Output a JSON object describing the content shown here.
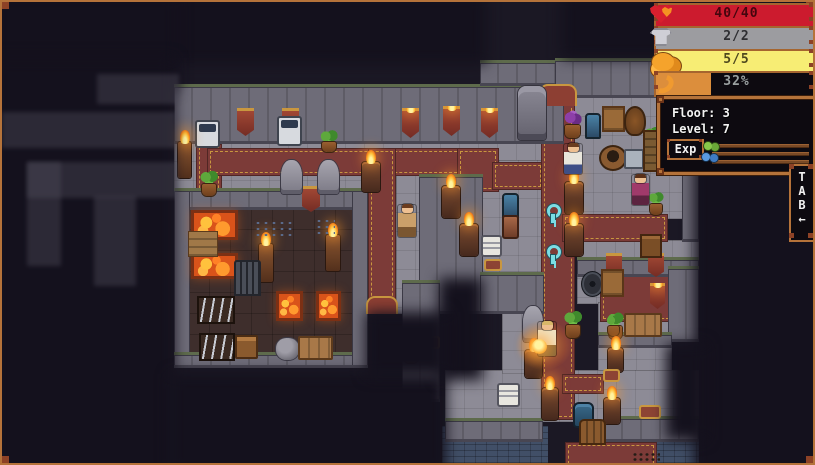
{
  "hud": {
    "bars": [
      {
        "name": "health-bar",
        "icon": "heart-icon",
        "label": "40/40",
        "fill_color": "#cc1b2e",
        "fill_pct": 100,
        "text_color": "#44060e",
        "y": 1
      },
      {
        "name": "armor-bar",
        "icon": "armor-icon",
        "label": "2/2",
        "fill_color": "#9c9ca0",
        "fill_pct": 100,
        "text_color": "#2e2e32",
        "y": 24
      },
      {
        "name": "charge-bar",
        "icon": "gold-icon",
        "label": "5/5",
        "fill_color": "#f7ed74",
        "fill_pct": 100,
        "text_color": "#4e481e",
        "y": 47
      },
      {
        "name": "hunger-bar",
        "icon": "horn-icon",
        "label": "32%",
        "fill_color": "#dc8e3c",
        "fill_pct": 34,
        "text_color": "#9aa0a0",
        "y": 69
      }
    ],
    "info": {
      "floor_label": "Floor: 3",
      "level_label": "Level: 7",
      "exp_button": "Exp"
    },
    "tab": {
      "l1": "T",
      "l2": "A",
      "l3": "B",
      "arrow": "←"
    }
  },
  "colors": {
    "frame": "#b5733a",
    "background": "#1b1824",
    "carpet": "#7c3b38",
    "gold_trim": "#c9973f",
    "lava": "#d9531a",
    "stone": "#8d8b96"
  },
  "map": {
    "tiles": [
      {
        "t": "stone",
        "r": [
          172,
          140,
          390,
          76
        ]
      },
      {
        "t": "stone",
        "r": [
          394,
          172,
          24,
          140
        ]
      },
      {
        "t": "stone",
        "r": [
          553,
          95,
          144,
          122
        ]
      },
      {
        "t": "stone",
        "r": [
          478,
          158,
          64,
          112
        ]
      },
      {
        "t": "stone",
        "r": [
          575,
          238,
          122,
          64
        ]
      },
      {
        "t": "stone",
        "r": [
          596,
          300,
          74,
          140
        ]
      },
      {
        "t": "stone",
        "r": [
          443,
          368,
          254,
          52
        ]
      },
      {
        "t": "stone",
        "r": [
          500,
          310,
          42,
          62
        ]
      },
      {
        "t": "forge",
        "r": [
          186,
          206,
          166,
          146
        ]
      },
      {
        "t": "water",
        "r": [
          440,
          424,
          106,
          40
        ]
      },
      {
        "t": "water",
        "r": [
          628,
          436,
          69,
          28
        ]
      },
      {
        "t": "carpet",
        "r": [
          194,
          142,
          26,
          52
        ]
      },
      {
        "t": "carpet",
        "r": [
          205,
          146,
          258,
          28
        ]
      },
      {
        "t": "carpet",
        "r": [
          455,
          146,
          42,
          44
        ]
      },
      {
        "t": "carpet",
        "r": [
          490,
          160,
          52,
          28
        ]
      },
      {
        "t": "carpet",
        "r": [
          366,
          146,
          28,
          166
        ]
      },
      {
        "t": "carpet",
        "r": [
          539,
          88,
          34,
          330
        ]
      },
      {
        "t": "carpet",
        "r": [
          560,
          212,
          106,
          28
        ]
      },
      {
        "t": "carpet",
        "r": [
          560,
          372,
          42,
          20
        ]
      },
      {
        "t": "carpet",
        "r": [
          598,
          264,
          72,
          56
        ]
      },
      {
        "t": "carpet",
        "r": [
          563,
          440,
          92,
          25
        ]
      },
      {
        "t": "wall",
        "r": [
          172,
          82,
          390,
          60
        ]
      },
      {
        "t": "wall",
        "r": [
          478,
          58,
          84,
          26
        ]
      },
      {
        "t": "wall",
        "r": [
          553,
          56,
          144,
          40
        ]
      },
      {
        "t": "wall",
        "r": [
          680,
          95,
          17,
          145
        ]
      },
      {
        "t": "wall",
        "r": [
          417,
          172,
          64,
          140
        ]
      },
      {
        "t": "wall",
        "r": [
          478,
          270,
          64,
          42
        ]
      },
      {
        "t": "wall",
        "r": [
          172,
          186,
          194,
          22
        ]
      },
      {
        "t": "wall",
        "r": [
          172,
          186,
          16,
          180
        ]
      },
      {
        "t": "wall",
        "r": [
          172,
          350,
          194,
          16
        ]
      },
      {
        "t": "wall",
        "r": [
          350,
          186,
          16,
          180
        ]
      },
      {
        "t": "wall",
        "r": [
          575,
          255,
          122,
          20
        ]
      },
      {
        "t": "wall",
        "r": [
          666,
          264,
          31,
          76
        ]
      },
      {
        "t": "wall",
        "r": [
          596,
          330,
          74,
          16
        ]
      },
      {
        "t": "wall",
        "r": [
          443,
          416,
          98,
          24
        ]
      },
      {
        "t": "wall",
        "r": [
          602,
          414,
          95,
          26
        ]
      },
      {
        "t": "wall",
        "r": [
          400,
          278,
          38,
          122
        ]
      }
    ],
    "objects": [
      {
        "t": "arch",
        "r": [
          537,
          82,
          38,
          22
        ]
      },
      {
        "t": "arch",
        "r": [
          364,
          294,
          32,
          18
        ]
      },
      {
        "t": "banner",
        "r": [
          235,
          106,
          17,
          28
        ]
      },
      {
        "t": "banner",
        "r": [
          280,
          106,
          17,
          28
        ]
      },
      {
        "t": "banner",
        "r": [
          300,
          184,
          18,
          26
        ]
      },
      {
        "t": "banner",
        "r": [
          604,
          251,
          16,
          24
        ]
      },
      {
        "t": "banner",
        "r": [
          646,
          251,
          16,
          24
        ]
      },
      {
        "t": "torch-wall",
        "r": [
          400,
          106,
          17,
          30
        ]
      },
      {
        "t": "torch-wall",
        "r": [
          441,
          104,
          17,
          30
        ]
      },
      {
        "t": "torch-wall",
        "r": [
          479,
          106,
          17,
          30
        ]
      },
      {
        "t": "torch-wall",
        "r": [
          648,
          281,
          15,
          26
        ]
      },
      {
        "t": "statue-face",
        "r": [
          516,
          84,
          28,
          54
        ]
      },
      {
        "t": "statue",
        "r": [
          279,
          158,
          21,
          34
        ]
      },
      {
        "t": "statue",
        "r": [
          316,
          158,
          21,
          34
        ]
      },
      {
        "t": "statue",
        "r": [
          521,
          304,
          20,
          36
        ]
      },
      {
        "t": "vending",
        "r": [
          193,
          118,
          25,
          28
        ],
        "i": 1
      },
      {
        "t": "vending",
        "r": [
          275,
          114,
          25,
          30
        ],
        "i": 1
      },
      {
        "t": "plant",
        "r": [
          316,
          128,
          22,
          22
        ]
      },
      {
        "t": "plant",
        "r": [
          196,
          168,
          22,
          26
        ]
      },
      {
        "t": "plant-purple",
        "r": [
          559,
          108,
          23,
          28
        ]
      },
      {
        "t": "plant",
        "r": [
          641,
          123,
          19,
          30
        ]
      },
      {
        "t": "plant",
        "r": [
          645,
          189,
          18,
          24
        ]
      },
      {
        "t": "plant",
        "r": [
          560,
          308,
          22,
          28
        ]
      },
      {
        "t": "plant",
        "r": [
          604,
          309,
          19,
          28
        ]
      },
      {
        "t": "plant",
        "r": [
          603,
          312,
          17,
          22
        ]
      },
      {
        "t": "plant-purple",
        "r": [
          398,
          333,
          22,
          28
        ]
      },
      {
        "t": "torch-stand",
        "r": [
          176,
          140,
          13,
          36
        ]
      },
      {
        "t": "torch-stand",
        "r": [
          257,
          242,
          14,
          38
        ]
      },
      {
        "t": "torch-stand",
        "r": [
          324,
          233,
          14,
          36
        ]
      },
      {
        "t": "brazier",
        "r": [
          360,
          160,
          18,
          30
        ]
      },
      {
        "t": "brazier",
        "r": [
          440,
          184,
          18,
          32
        ]
      },
      {
        "t": "brazier",
        "r": [
          458,
          222,
          18,
          32
        ]
      },
      {
        "t": "brazier",
        "r": [
          563,
          180,
          18,
          32
        ]
      },
      {
        "t": "brazier",
        "r": [
          563,
          222,
          18,
          32
        ]
      },
      {
        "t": "brazier",
        "r": [
          523,
          348,
          17,
          28
        ]
      },
      {
        "t": "brazier",
        "r": [
          540,
          386,
          16,
          32
        ]
      },
      {
        "t": "brazier",
        "r": [
          602,
          396,
          16,
          26
        ]
      },
      {
        "t": "brazier",
        "r": [
          606,
          346,
          15,
          24
        ]
      },
      {
        "t": "crate",
        "r": [
          600,
          104,
          23,
          26
        ],
        "i": 1
      },
      {
        "t": "basket",
        "r": [
          622,
          104,
          22,
          30
        ]
      },
      {
        "t": "well",
        "r": [
          597,
          143,
          28,
          26
        ],
        "i": 1
      },
      {
        "t": "chute",
        "r": [
          622,
          147,
          20,
          20
        ]
      },
      {
        "t": "shelf",
        "r": [
          641,
          128,
          20,
          42
        ]
      },
      {
        "t": "totem-blue",
        "r": [
          583,
          111,
          16,
          26
        ]
      },
      {
        "t": "totem-blue",
        "r": [
          500,
          191,
          17,
          26
        ]
      },
      {
        "t": "pillar",
        "r": [
          500,
          213,
          17,
          24
        ]
      },
      {
        "t": "cabinet",
        "r": [
          638,
          232,
          22,
          24
        ],
        "i": 1
      },
      {
        "t": "gear",
        "r": [
          580,
          270,
          21,
          24
        ]
      },
      {
        "t": "crate",
        "r": [
          599,
          267,
          23,
          28
        ],
        "i": 1
      },
      {
        "t": "bench",
        "r": [
          622,
          311,
          38,
          24
        ]
      },
      {
        "t": "lava",
        "r": [
          189,
          208,
          47,
          30
        ]
      },
      {
        "t": "lava",
        "r": [
          189,
          251,
          47,
          26
        ]
      },
      {
        "t": "ramp",
        "r": [
          186,
          229,
          30,
          26
        ]
      },
      {
        "t": "lava",
        "r": [
          274,
          289,
          27,
          30
        ]
      },
      {
        "t": "lava",
        "r": [
          314,
          289,
          25,
          30
        ]
      },
      {
        "t": "debris",
        "r": [
          252,
          218,
          38,
          18
        ]
      },
      {
        "t": "debris",
        "r": [
          313,
          216,
          20,
          16
        ]
      },
      {
        "t": "anvil",
        "r": [
          232,
          258,
          27,
          36
        ],
        "i": 1
      },
      {
        "t": "rack",
        "r": [
          195,
          294,
          38,
          28
        ],
        "i": 1
      },
      {
        "t": "rack",
        "r": [
          197,
          331,
          36,
          28
        ],
        "i": 1
      },
      {
        "t": "chest",
        "r": [
          233,
          333,
          23,
          24
        ],
        "i": 1
      },
      {
        "t": "rock",
        "r": [
          274,
          336,
          23,
          22
        ]
      },
      {
        "t": "bench",
        "r": [
          296,
          334,
          35,
          24
        ]
      },
      {
        "t": "key",
        "r": [
          543,
          202,
          15,
          20
        ],
        "i": 1
      },
      {
        "t": "key",
        "r": [
          543,
          243,
          15,
          20
        ],
        "i": 1
      },
      {
        "t": "sign",
        "r": [
          479,
          233,
          21,
          22
        ],
        "i": 1
      },
      {
        "t": "sign",
        "r": [
          495,
          381,
          23,
          24
        ],
        "i": 1
      },
      {
        "t": "bench-red",
        "r": [
          419,
          334,
          19,
          13
        ]
      },
      {
        "t": "bench-red",
        "r": [
          482,
          257,
          18,
          12
        ]
      },
      {
        "t": "bench-red",
        "r": [
          637,
          403,
          22,
          14
        ]
      },
      {
        "t": "bench-red",
        "r": [
          601,
          367,
          17,
          13
        ]
      },
      {
        "t": "barrel-blue",
        "r": [
          571,
          400,
          21,
          26
        ],
        "i": 1
      },
      {
        "t": "door",
        "r": [
          577,
          417,
          27,
          26
        ],
        "i": 1
      },
      {
        "t": "debris-dark",
        "r": [
          630,
          450,
          28,
          10
        ]
      },
      {
        "t": "glow",
        "r": [
          514,
          318,
          56,
          50
        ]
      },
      {
        "t": "npc",
        "r": [
          562,
          142,
          18,
          30
        ],
        "i": 1,
        "hair": "#6b3c1e",
        "shirt": "#e9e6dc",
        "pants": "#3e4f86"
      },
      {
        "t": "npc",
        "r": [
          630,
          173,
          17,
          30
        ],
        "i": 1,
        "hair": "#5a3018",
        "shirt": "#a03a6a",
        "pants": "#5c2440"
      },
      {
        "t": "npc",
        "r": [
          396,
          203,
          18,
          32
        ],
        "i": 1,
        "hair": "#6b3c1e",
        "shirt": "#caa06a",
        "pants": "#7a5630"
      },
      {
        "t": "npc",
        "r": [
          536,
          320,
          18,
          34
        ],
        "i": 1,
        "hair": "#d8b86a",
        "shirt": "#efe3c4",
        "pants": "#8a6a3c"
      },
      {
        "t": "orb",
        "r": [
          530,
          337,
          15,
          15
        ]
      }
    ],
    "fog": [
      {
        "t": "fogx",
        "r": [
          -8,
          -8,
          492,
          70
        ]
      },
      {
        "t": "fogx",
        "r": [
          -8,
          -8,
          184,
          96
        ]
      },
      {
        "t": "fogx",
        "r": [
          -8,
          56,
          180,
          420
        ]
      },
      {
        "t": "fogx",
        "r": [
          168,
          372,
          276,
          100
        ]
      },
      {
        "t": "fogx",
        "r": [
          437,
          276,
          44,
          102
        ]
      },
      {
        "t": "fogx",
        "r": [
          364,
          310,
          82,
          64
        ]
      },
      {
        "t": "fogx",
        "r": [
          560,
          -8,
          140,
          64
        ]
      },
      {
        "t": "fogx",
        "r": [
          692,
          -8,
          130,
          482
        ]
      },
      {
        "t": "fogx",
        "r": [
          664,
          342,
          40,
          96
        ]
      },
      {
        "t": "dim",
        "r": [
          95,
          72,
          82,
          30
        ]
      },
      {
        "t": "dim",
        "r": [
          0,
          110,
          174,
          36
        ]
      },
      {
        "t": "dim",
        "r": [
          25,
          160,
          150,
          36
        ]
      },
      {
        "t": "dim",
        "r": [
          25,
          160,
          34,
          104
        ]
      },
      {
        "t": "dim",
        "r": [
          92,
          194,
          42,
          90
        ]
      }
    ]
  }
}
